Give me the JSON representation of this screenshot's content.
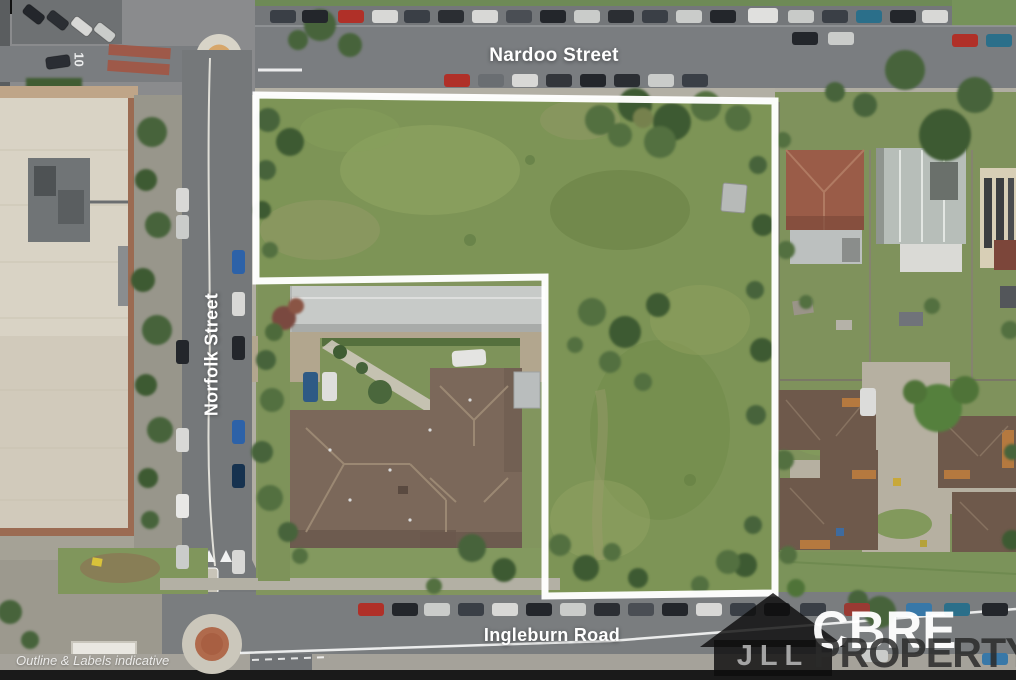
{
  "labels": {
    "street_top": "Nardoo Street",
    "street_left": "Norfolk Street",
    "street_bottom": "Ingleburn Road",
    "disclaimer": "Outline & Labels indicative",
    "road_marking": "10"
  },
  "watermarks": {
    "jll_letters": "JLL",
    "jll_icon": "house-silhouette-icon",
    "cbre": "CBRE",
    "property": "PROPERTY"
  },
  "colors": {
    "site_outline": "#ffffff",
    "road_asphalt": "#77797c",
    "grass_field": "#7d9456",
    "tree_canopy": "#46633a",
    "house_roof": "#7b685a",
    "warehouse_roof": "#c7cac8",
    "commercial_roof": "#d9d3c5",
    "cbre_watermark": "#ffffff",
    "jll_watermark": "#111111",
    "property_watermark": "#2a2a2a"
  }
}
